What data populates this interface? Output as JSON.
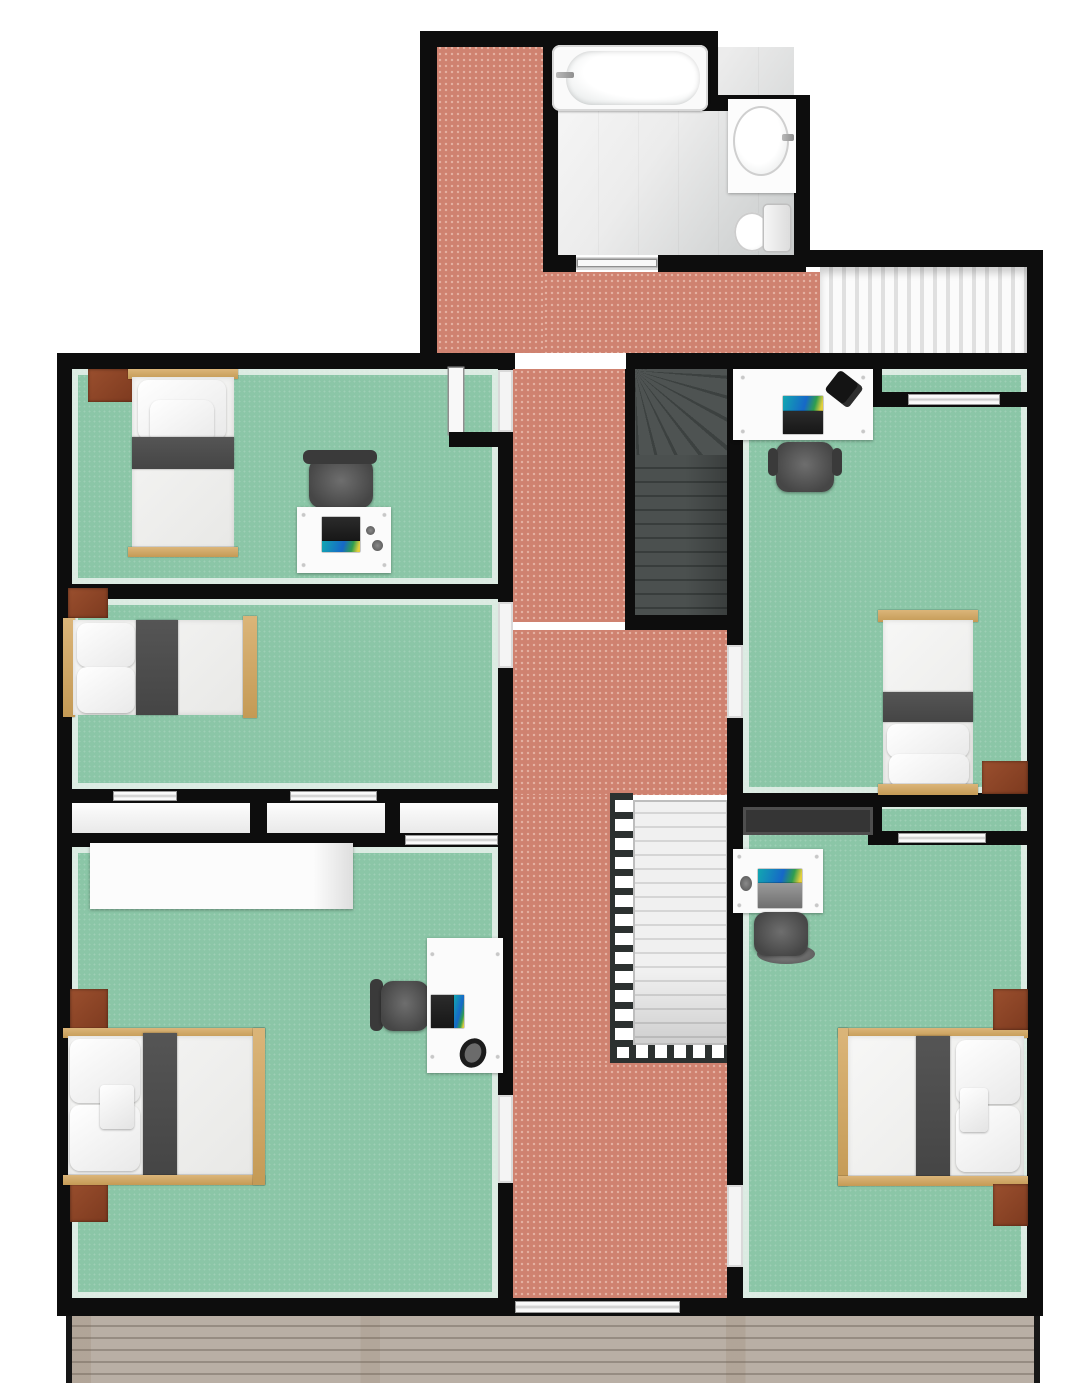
{
  "title": "Upper floor plan - 3D top-down architectural rendering",
  "view": "orthographic top view, no text labels",
  "colors": {
    "wall": "#0d0d0d",
    "carpet": "#8bc6a7",
    "hall": "#cf8270",
    "deck-a": "#b9afa5",
    "deck-b": "#968c82",
    "wood": "#dbb579",
    "nightstand": "#7d3a1f",
    "stripe": "#454545",
    "desk": "#fbfbfb",
    "chair": "#464646",
    "rail": "#2c3130",
    "wardrobe": "#353535"
  },
  "rooms": [
    {
      "name": "bathroom",
      "position": "top-center",
      "floor": "gray tile",
      "fixtures": [
        "bathtub",
        "vanity-sink",
        "toilet"
      ],
      "door": "bottom wall to hallway"
    },
    {
      "name": "linen-closet",
      "position": "top-right",
      "floor": "white slatted shelving",
      "open_to": "hallway"
    },
    {
      "name": "bedroom-top-left",
      "floor": "green carpet",
      "furniture": [
        "single-bed",
        "nightstand",
        "desk",
        "office-chair",
        "laptop",
        "mouse",
        "open-door-leaf"
      ]
    },
    {
      "name": "bedroom-middle-left",
      "floor": "green carpet",
      "furniture": [
        "single-bed",
        "nightstand"
      ],
      "closets": "two sliding-door closets on south wall"
    },
    {
      "name": "bedroom-bottom-left",
      "floor": "green carpet",
      "furniture": [
        "double-bed",
        "nightstand",
        "nightstand",
        "long-white-dresser",
        "desk",
        "office-chair",
        "laptop",
        "headphones"
      ]
    },
    {
      "name": "bedroom-top-right",
      "floor": "green carpet",
      "furniture": [
        "single-bed",
        "nightstand",
        "desk",
        "office-chair",
        "laptop",
        "desk-phone"
      ],
      "closets": "sliding-door closet in north-east corner"
    },
    {
      "name": "bedroom-bottom-right",
      "floor": "green carpet",
      "furniture": [
        "double-bed",
        "nightstand",
        "nightstand",
        "dark-wardrobe",
        "desk",
        "office-chair",
        "laptop",
        "mouse"
      ],
      "closets": "sliding-door closet on north wall"
    },
    {
      "name": "hallway",
      "floor": "terracotta tile",
      "connects": [
        "bathroom",
        "all bedrooms",
        "stairs",
        "deck-door"
      ]
    },
    {
      "name": "stairwell-upper",
      "type": "dark winder staircase",
      "position": "center"
    },
    {
      "name": "stairwell-lower",
      "type": "light open staircase with dark balustrade",
      "position": "center-bottom"
    },
    {
      "name": "deck",
      "position": "bottom edge",
      "floor": "horizontal wood planks",
      "access": "sliding door from hallway"
    }
  ],
  "counts": {
    "bedrooms": 5,
    "bathrooms": 1,
    "staircases": 2,
    "beds": 5,
    "desks": 4,
    "office_chairs": 4,
    "laptops": 4,
    "nightstands": 7
  }
}
